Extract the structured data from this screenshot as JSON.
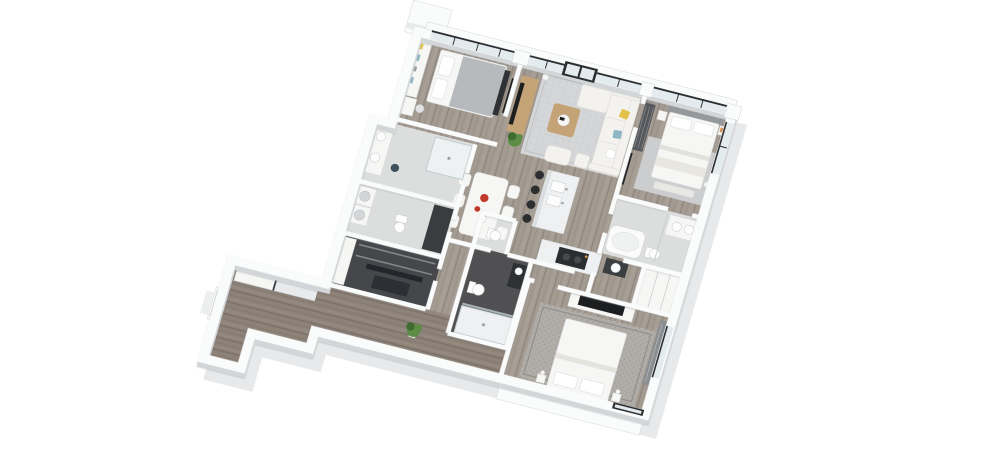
{
  "scene": {
    "description": "3D isometric render of an apartment floor plan on a white background, rotated clockwise, with white walls, gray wood floors, three bedrooms, living-dining area, kitchen island and several bathrooms",
    "background": "#ffffff"
  },
  "palette": {
    "paper": "#ffffff",
    "shadow": "#e8e9ea",
    "wall": "#fafbfb",
    "wall_edge": "#d3d6d8",
    "floor_wood": "#a39a90",
    "floor_wood_dark": "#8d8278",
    "floor_light": "#dcdddd",
    "floor_dark": "#505052",
    "floor_closet": "#45474a",
    "glass": "#e4ebee",
    "frame": "#2b2e31",
    "rug": "#d5d6d8",
    "rug2": "#cbcdcf",
    "rug3": "#b0aca7",
    "sofa": "#f3f2ef",
    "white_furn": "#f6f6f4",
    "wood_furn": "#c4a377",
    "tv": "#1c1e20",
    "yellow": "#e2c24d",
    "blue": "#8fb6c4",
    "red": "#c03a2c",
    "orange": "#d78f4e",
    "green": "#5d8c46",
    "green_dark": "#3f6b31",
    "stool": "#2c2e30",
    "marble": "#eef0f1",
    "gray_furn": "#55585c",
    "steel": "#95999c"
  },
  "rooms": [
    {
      "id": "bedroom-top-left",
      "furniture": [
        "bed",
        "bookshelf",
        "desk",
        "wall-tv"
      ]
    },
    {
      "id": "living-room",
      "furniture": [
        "sofa",
        "chaise",
        "armchair",
        "coffee-table",
        "tv-console",
        "tv",
        "floor-lamp",
        "plant",
        "rug"
      ]
    },
    {
      "id": "master-bedroom",
      "furniture": [
        "bed",
        "nightstands",
        "bench",
        "wardrobe",
        "wall-tv",
        "rug"
      ]
    },
    {
      "id": "master-bathroom",
      "furniture": [
        "bathtub",
        "vanity",
        "toilet",
        "glass-divider"
      ]
    },
    {
      "id": "bathroom-2",
      "furniture": [
        "double-vanity",
        "shower",
        "stool"
      ]
    },
    {
      "id": "laundry-wc",
      "furniture": [
        "washer",
        "dryer",
        "toilet",
        "counter"
      ]
    },
    {
      "id": "walk-in-closet",
      "furniture": [
        "shelving",
        "boxes"
      ]
    },
    {
      "id": "kitchen",
      "furniture": [
        "island",
        "double-sink",
        "cooktop",
        "bar-stools"
      ]
    },
    {
      "id": "dining-area",
      "furniture": [
        "table",
        "six-chairs",
        "red-tableware"
      ]
    },
    {
      "id": "wc-2",
      "furniture": [
        "toilet"
      ]
    },
    {
      "id": "bathroom-3",
      "furniture": [
        "toilet",
        "walk-in-shower",
        "dark-vanity"
      ]
    },
    {
      "id": "bedroom-bottom-right",
      "furniture": [
        "bed",
        "tv-console",
        "tv",
        "patterned-rug",
        "wardrobe",
        "nightstands"
      ]
    },
    {
      "id": "entry-hall",
      "furniture": [
        "sliding-closets",
        "plant",
        "entry-door"
      ]
    }
  ]
}
